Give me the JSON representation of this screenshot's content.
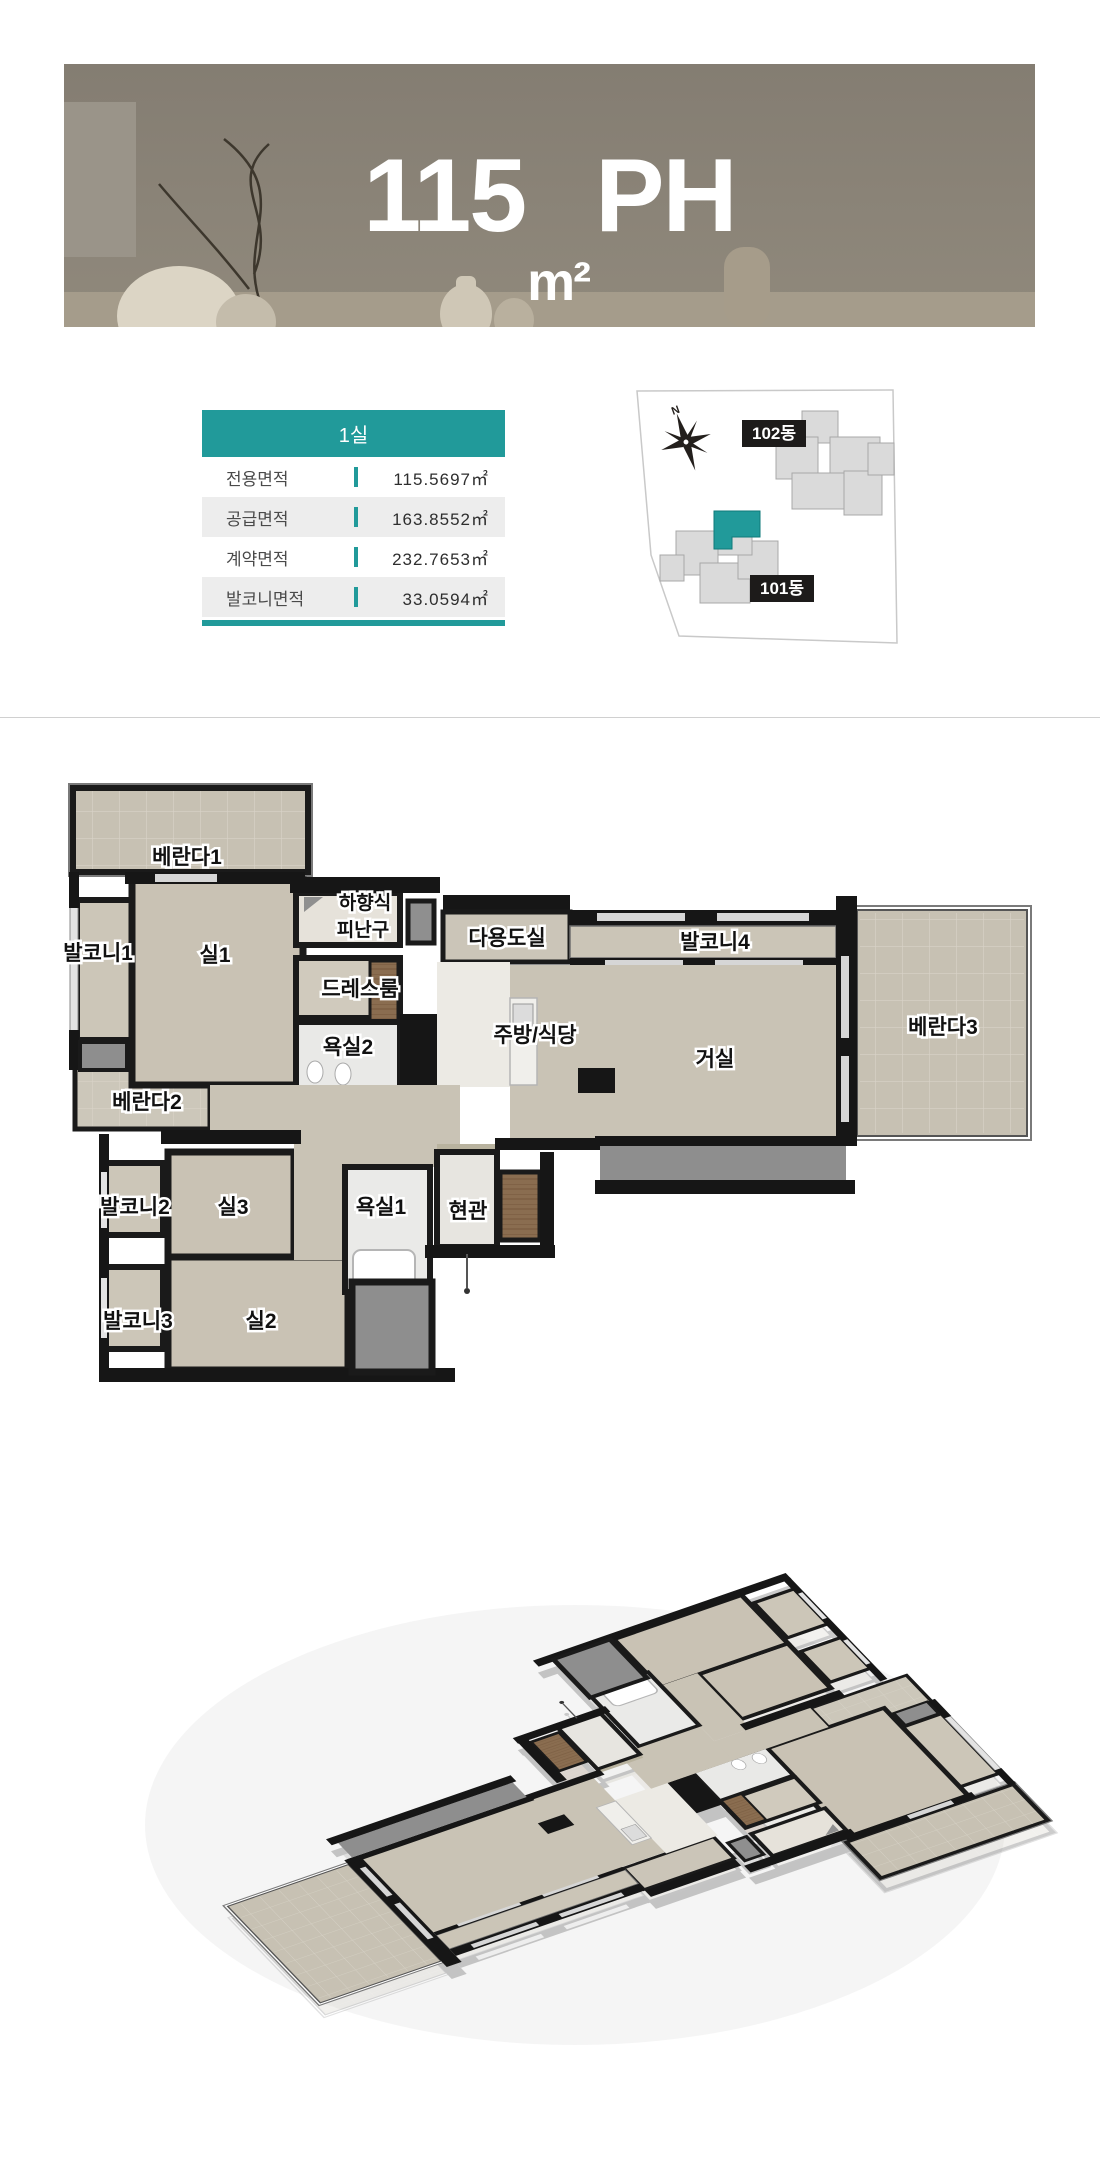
{
  "banner": {
    "title_area": "115",
    "title_unit": "m²",
    "title_suffix": "PH"
  },
  "info_table": {
    "header": "1실",
    "rows": [
      {
        "label": "전용면적",
        "value": "115.5697㎡"
      },
      {
        "label": "공급면적",
        "value": "163.8552㎡"
      },
      {
        "label": "계약면적",
        "value": "232.7653㎡"
      },
      {
        "label": "발코니면적",
        "value": "33.0594㎡"
      }
    ],
    "accent_color": "#219a9a"
  },
  "site_map": {
    "north": "N",
    "building_102": "102동",
    "building_101": "101동",
    "highlight_color": "#219a9a"
  },
  "floor_plan": {
    "rooms": {
      "veranda1": "베란다1",
      "balcony1": "발코니1",
      "room1": "실1",
      "escape_hatch_line1": "하향식",
      "escape_hatch_line2": "피난구",
      "dress_room": "드레스룸",
      "bath2": "욕실2",
      "utility": "다용도실",
      "balcony4": "발코니4",
      "kitchen_dining": "주방/식당",
      "living": "거실",
      "veranda3": "베란다3",
      "veranda2": "베란다2",
      "balcony2": "발코니2",
      "room3": "실3",
      "bath1": "욕실1",
      "entrance": "현관",
      "balcony3": "발코니3",
      "room2": "실2"
    }
  }
}
